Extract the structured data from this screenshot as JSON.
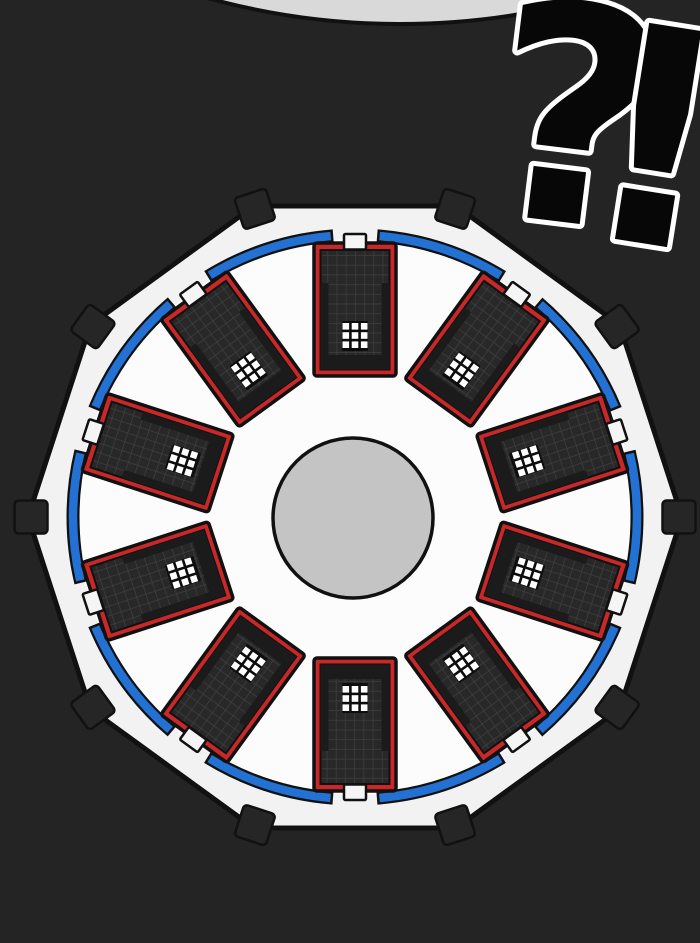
{
  "overlay": {
    "question_mark": "?",
    "exclamation_mark": "!"
  },
  "scene": {
    "description": "Top-down comic-panel view of a circular prison facility: ten red-framed cell blocks arranged radially inside a white decagonal wall with black corner blocks, a blue perimeter ring with door gaps, and a gray central yard. A large ?! shout mark sits top right.",
    "building_count": 10,
    "corner_block_count": 10,
    "window_grid": {
      "rows": 3,
      "cols": 3
    },
    "colors": {
      "background": "#242424",
      "outline": "#111111",
      "top_figure": "#d9d9d9",
      "courtyard": "#f2f2f2",
      "courtyard_inner": "#fcfcfc",
      "perimeter_ring": "#2271d3",
      "building_frame": "#c82828",
      "building_roof": "#282828",
      "roof_grid_line": "#404040",
      "building_wall": "#1b1b1b",
      "window_base": "#0d0d0d",
      "window_light": "#ffffff",
      "door": "#f5f5f5",
      "corner_block": "#262626",
      "central_yard": "#c4c4c4",
      "text_fill": "#070707",
      "text_outline": "#ffffff"
    }
  }
}
